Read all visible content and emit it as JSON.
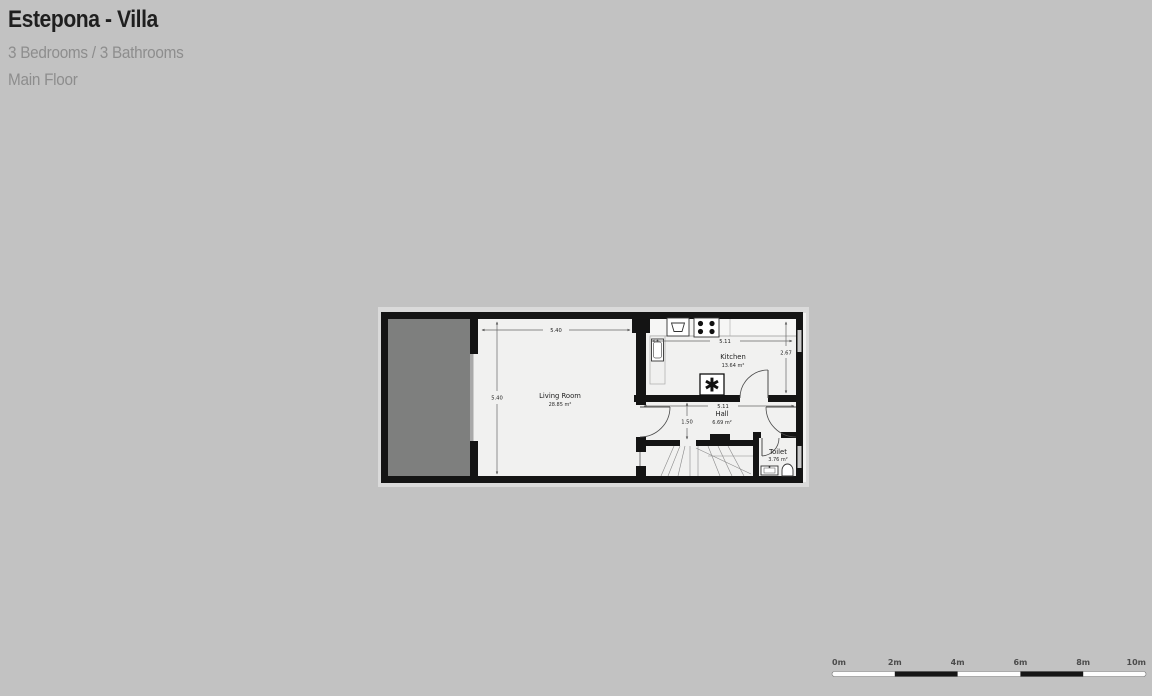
{
  "header": {
    "title": "Estepona - Villa",
    "subtitle": "3 Bedrooms / 3 Bathrooms",
    "floor_label": "Main Floor"
  },
  "floorplan": {
    "rooms": [
      {
        "name": "Living Room",
        "area": "28.85 m²",
        "width": "5.40",
        "height": "5.40"
      },
      {
        "name": "Kitchen",
        "area": "13.64 m²",
        "width": "5.11",
        "height": "2.67"
      },
      {
        "name": "Hall",
        "area": "6.69 m²",
        "width": "5.11",
        "height": "1.50"
      },
      {
        "name": "Toilet",
        "area": "3.76 m²"
      }
    ],
    "appliance_glyph": "✱",
    "colors": {
      "background": "#c2c2c2",
      "plan_backing": "#dadada",
      "wall": "#141414",
      "room_fill": "#f1f1f0",
      "terrace_fill": "#7e7f7e",
      "window": "#c9c9c9"
    }
  },
  "scalebar": {
    "labels": [
      "0m",
      "2m",
      "4m",
      "6m",
      "8m",
      "10m"
    ]
  }
}
